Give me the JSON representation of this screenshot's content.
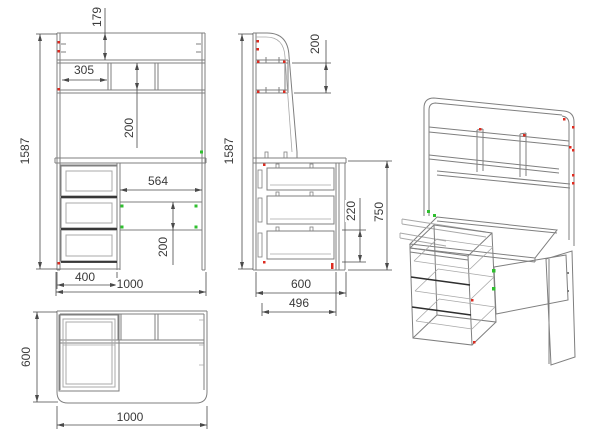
{
  "colors": {
    "background": "#ffffff",
    "line": "#7f7f7f",
    "line_light": "#a8a8a8",
    "line_dark": "#2e2e2e",
    "dimension": "#4a4a4a",
    "marker_red": "#dd2b20",
    "marker_green": "#2fbf2f"
  },
  "views": {
    "front": {
      "label": "front-view",
      "dims": {
        "total_height": "1587",
        "back_top_offset": "179",
        "shelf_compartment_width": "305",
        "shelf_compartment_height": "200",
        "knee_opening_width": "564",
        "modesty_panel_height": "200",
        "drawer_unit_width": "400",
        "total_width": "1000"
      }
    },
    "side": {
      "label": "side-view",
      "dims": {
        "total_height": "1587",
        "hutch_shelf_height": "200",
        "drawer_stack_height": "220",
        "worktop_height": "750",
        "total_depth": "600",
        "modesty_panel_depth": "496"
      }
    },
    "top": {
      "label": "top-view",
      "dims": {
        "total_depth": "600",
        "total_width": "1000"
      }
    },
    "isometric": {
      "label": "isometric-view"
    }
  }
}
